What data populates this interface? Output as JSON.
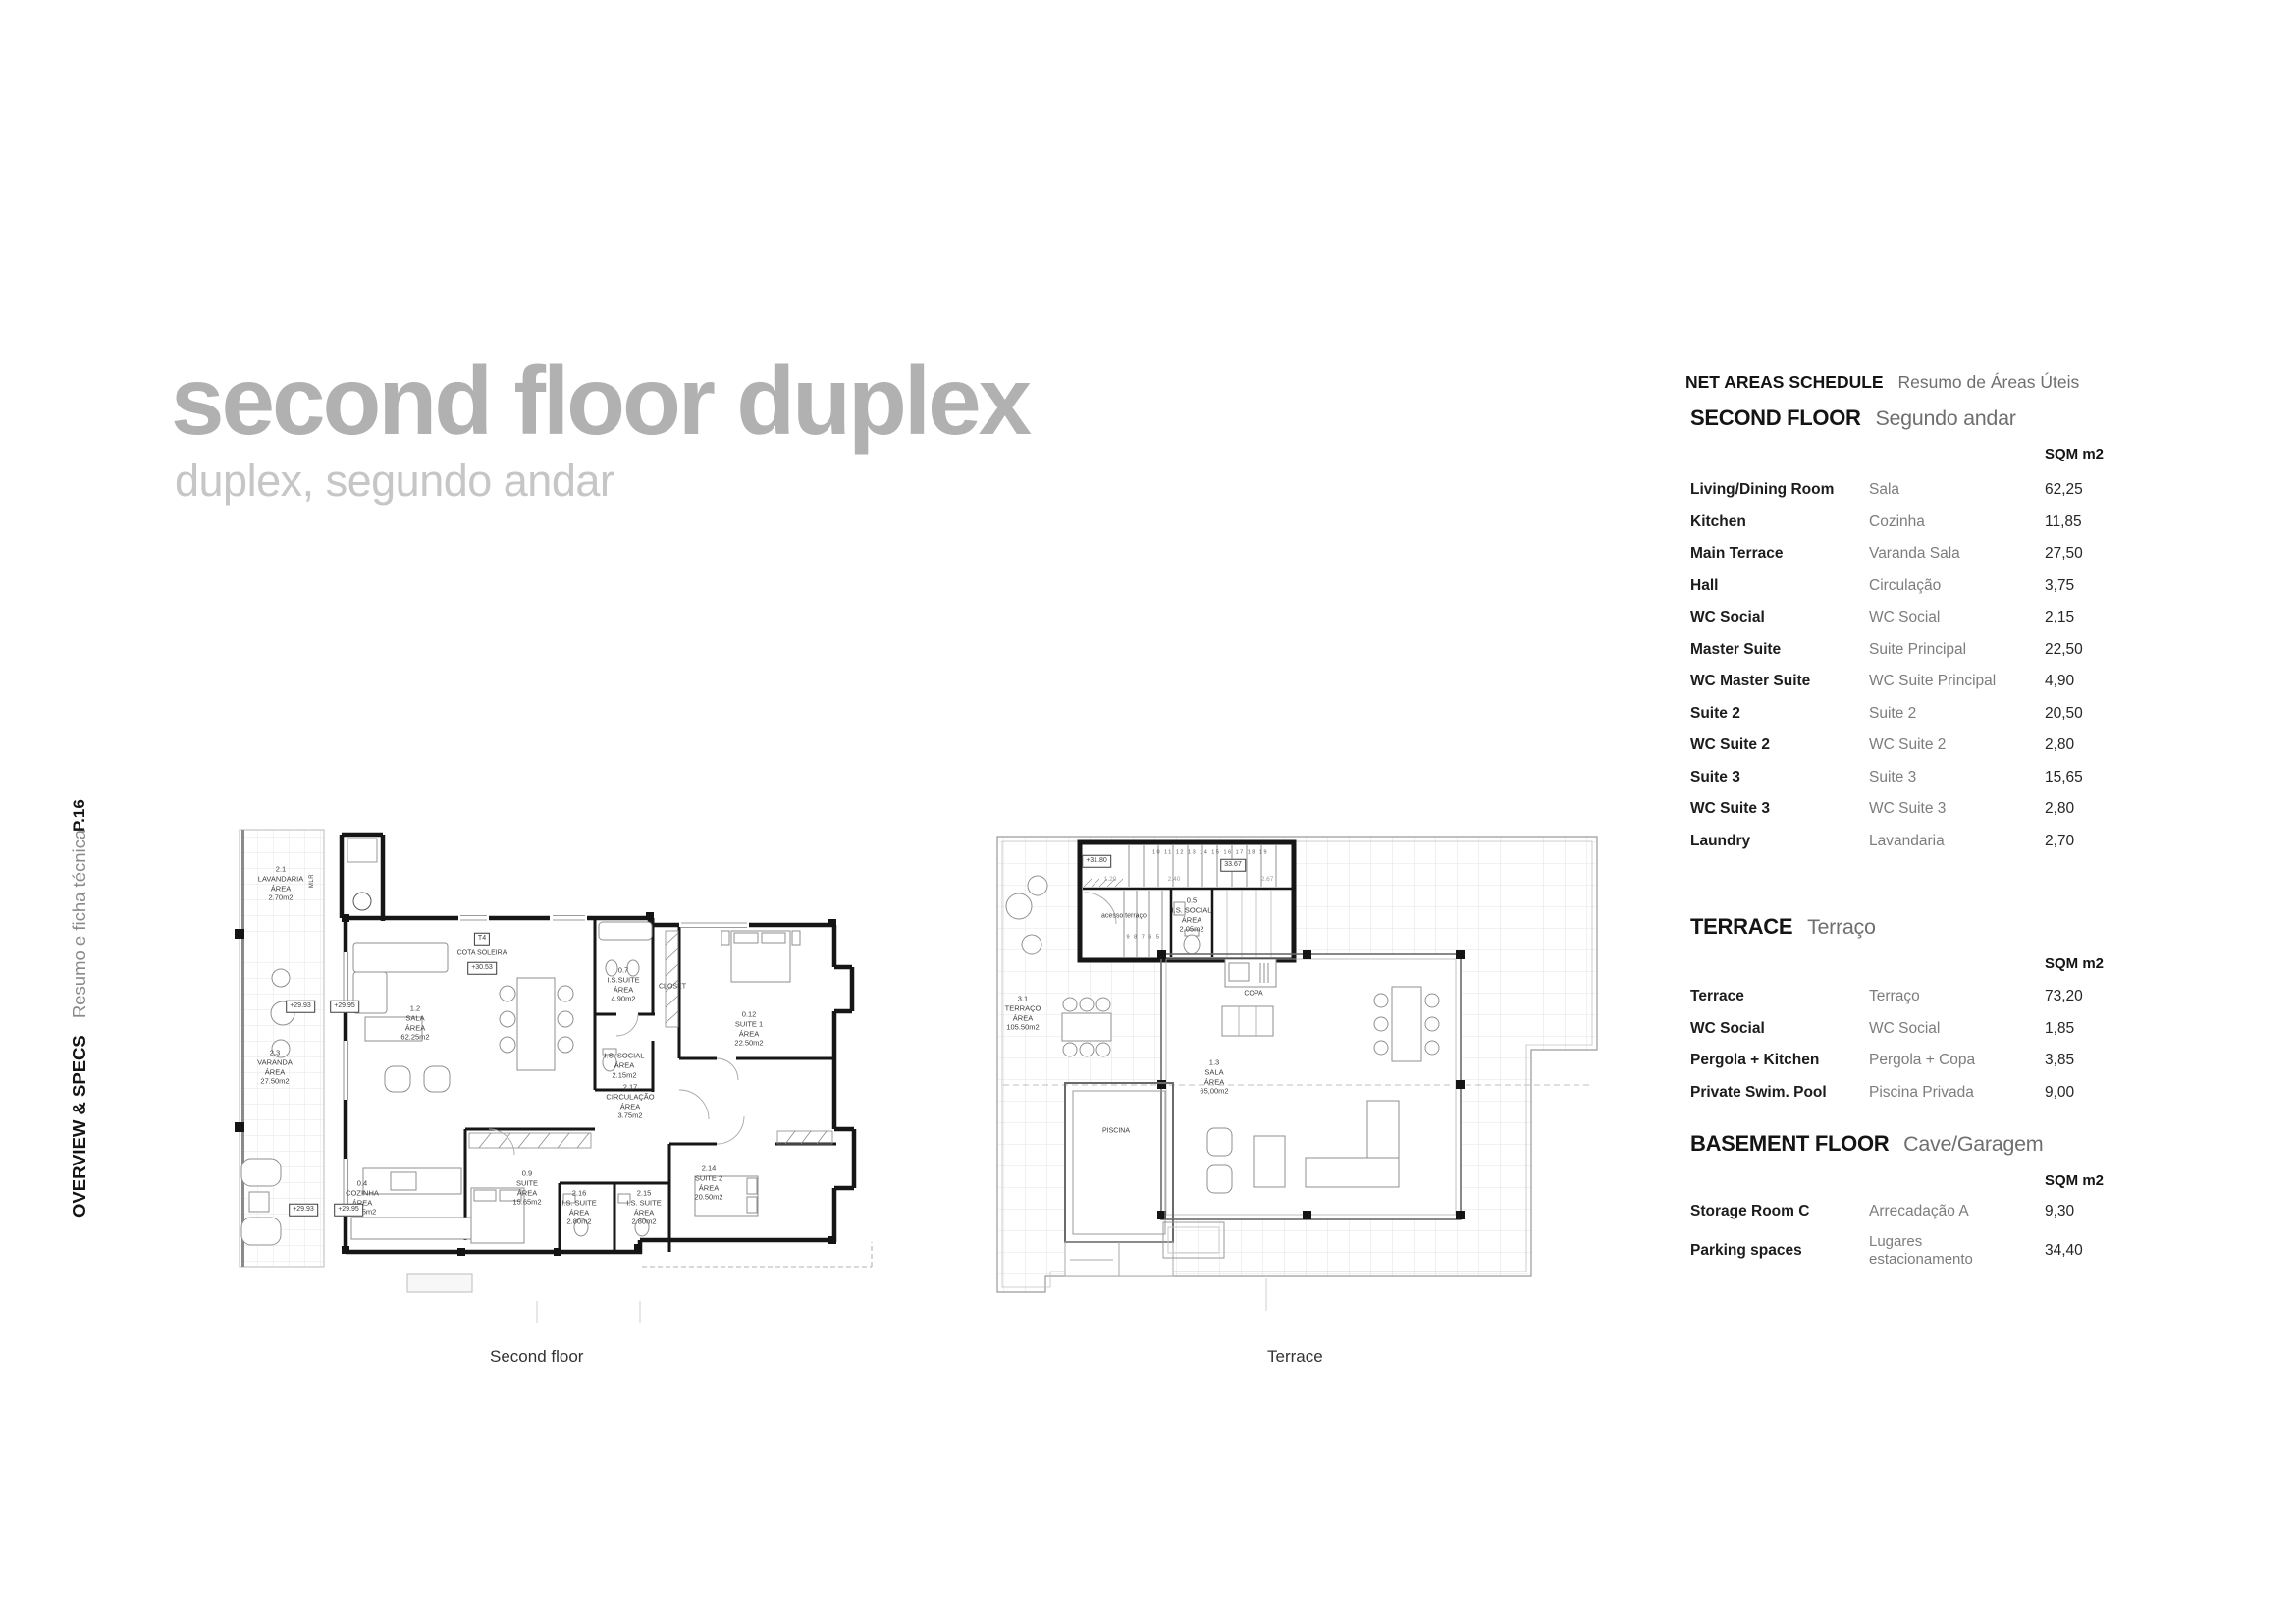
{
  "page": {
    "title": "second floor duplex",
    "subtitle": "duplex, segundo andar",
    "page_number": "P.16",
    "sidebar": {
      "section": "OVERVIEW & SPECS",
      "section_pt": "Resumo e ficha técnica"
    },
    "colors": {
      "title_gray": "#b1b1b1",
      "subtitle_gray": "#c6c6c6",
      "text_dark": "#1c1c1c",
      "text_muted": "#7d7d7d"
    }
  },
  "schedule": {
    "header": {
      "en": "NET AREAS SCHEDULE",
      "pt": "Resumo de Áreas Úteis"
    },
    "unit_label": "SQM m2",
    "sections": [
      {
        "title_en": "SECOND FLOOR",
        "title_pt": "Segundo andar",
        "rows": [
          {
            "en": "Living/Dining Room",
            "pt": "Sala",
            "area": "62,25"
          },
          {
            "en": "Kitchen",
            "pt": "Cozinha",
            "area": "11,85"
          },
          {
            "en": "Main Terrace",
            "pt": "Varanda Sala",
            "area": "27,50"
          },
          {
            "en": "Hall",
            "pt": "Circulação",
            "area": "3,75"
          },
          {
            "en": "WC Social",
            "pt": "WC Social",
            "area": "2,15"
          },
          {
            "en": "Master Suite",
            "pt": "Suite Principal",
            "area": "22,50"
          },
          {
            "en": "WC Master Suite",
            "pt": "WC Suite Principal",
            "area": "4,90"
          },
          {
            "en": "Suite 2",
            "pt": "Suite 2",
            "area": "20,50"
          },
          {
            "en": "WC Suite 2",
            "pt": "WC Suite 2",
            "area": "2,80"
          },
          {
            "en": "Suite 3",
            "pt": "Suite 3",
            "area": "15,65"
          },
          {
            "en": "WC Suite 3",
            "pt": "WC Suite 3",
            "area": "2,80"
          },
          {
            "en": "Laundry",
            "pt": "Lavandaria",
            "area": "2,70"
          }
        ]
      },
      {
        "title_en": "TERRACE",
        "title_pt": "Terraço",
        "rows": [
          {
            "en": "Terrace",
            "pt": "Terraço",
            "area": "73,20"
          },
          {
            "en": "WC Social",
            "pt": "WC Social",
            "area": "1,85"
          },
          {
            "en": "Pergola + Kitchen",
            "pt": "Pergola + Copa",
            "area": "3,85"
          },
          {
            "en": "Private Swim. Pool",
            "pt": "Piscina Privada",
            "area": "9,00"
          }
        ]
      },
      {
        "title_en": "BASEMENT FLOOR",
        "title_pt": "Cave/Garagem",
        "rows": [
          {
            "en": "Storage Room C",
            "pt": "Arrecadação A",
            "area": "9,30"
          },
          {
            "en": "Parking spaces",
            "pt": "Lugares\nestacionamento",
            "area": "34,40"
          }
        ]
      }
    ]
  },
  "plans": {
    "second_floor": {
      "caption": "Second floor",
      "labels": {
        "lavandaria": "2.1\nLAVANDARIA\nÁREA\n2.70m2",
        "mlr": "MLR",
        "level_top_a": "+29.93",
        "level_top_b": "+29.95",
        "t4": "T4",
        "cota_soleira": "COTA SOLEIRA",
        "cota_level": "+30.53",
        "varanda": "2.3\nVARANDA\nÁREA\n27.50m2",
        "sala": "1.2\nSALA\nÁREA\n62.25m2",
        "is_suite": "0.7\nI.S.SUITE\nÁREA\n4.90m2",
        "closet": "CLOSET",
        "suite1": "0.12\nSUITE 1\nÁREA\n22.50m2",
        "is_social": "I.S. SOCIAL\nÁREA\n2.15m2",
        "circulacao": "2.17\nCIRCULAÇÃO\nÁREA\n3.75m2",
        "cozinha": "0.4\nCOZINHA\nÁREA\n11.85m2",
        "suite": "0.9\nSUITE\nÁREA\n15.65m2",
        "is_suite_a": "2.16\nI.S. SUITE\nÁREA\n2.80m2",
        "is_suite_b": "2.15\nI.S. SUITE\nÁREA\n2.80m2",
        "suite2": "2.14\nSUITE 2\nÁREA\n20.50m2",
        "level_bottom_a": "+29.93",
        "level_bottom_b": "+29.95"
      }
    },
    "terrace": {
      "caption": "Terrace",
      "labels": {
        "level": "+31.80",
        "cota": "33.67",
        "stair_numbers_top": "10 11 12 13 14 15 16 17 18 19",
        "stair_numbers_bottom": "9 8 7 6 5",
        "dim_a": "1.20",
        "dim_b": "2.40",
        "dim_c": "2.67",
        "acesso": "acesso terraço",
        "is_social": "0.5\nI.S. SOCIAL\nÁREA\n2.05m2",
        "terraco": "3.1\nTERRAÇO\nÁREA\n105.50m2",
        "copa": "COPA",
        "sala": "1.3\nSALA\nÁREA\n65,00m2",
        "piscina": "PISCINA"
      }
    }
  }
}
